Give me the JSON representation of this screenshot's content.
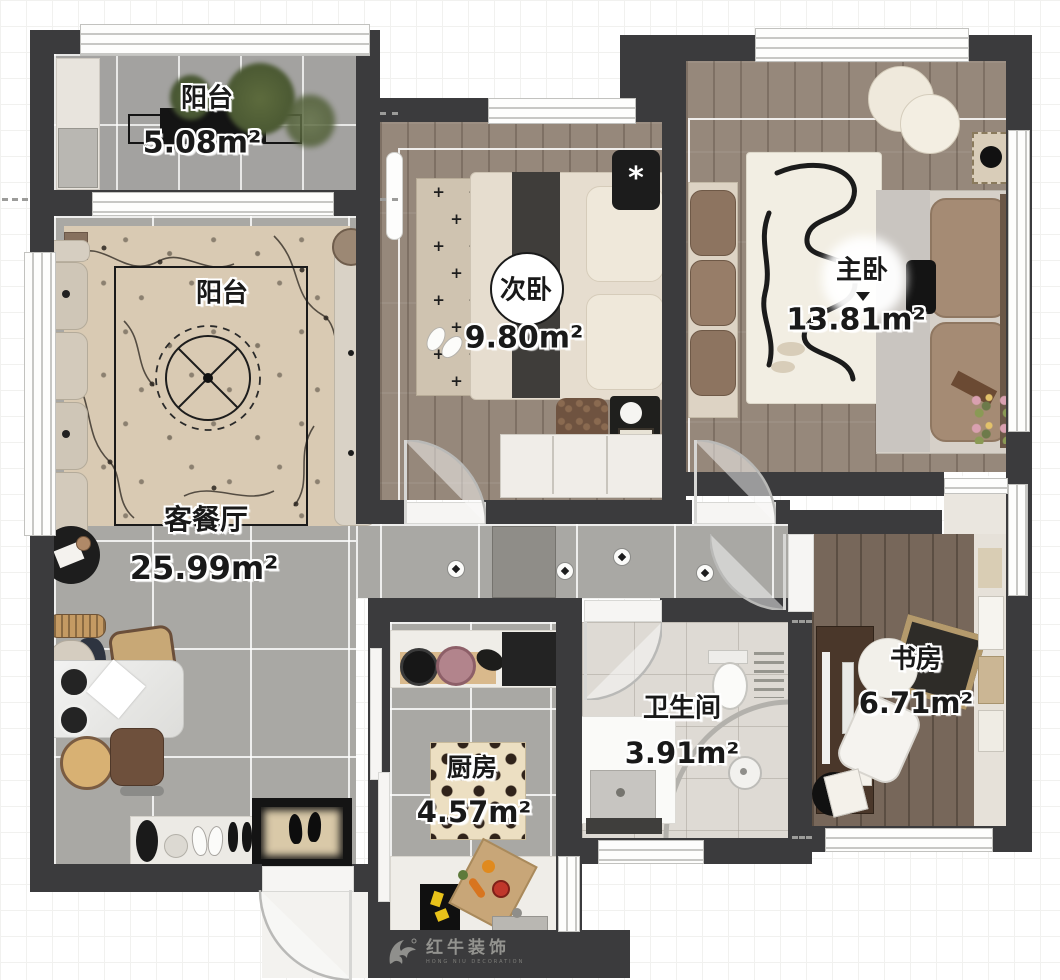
{
  "rooms": [
    {
      "id": "balcony-top",
      "name": "阳台",
      "area": "5.08m²"
    },
    {
      "id": "balcony-living",
      "name": "阳台",
      "area": ""
    },
    {
      "id": "bedroom-second",
      "name": "次卧",
      "area": "9.80m²"
    },
    {
      "id": "bedroom-master",
      "name": "主卧",
      "area": "13.81m²"
    },
    {
      "id": "living-dining",
      "name": "客餐厅",
      "area": "25.99m²"
    },
    {
      "id": "bathroom",
      "name": "卫生间",
      "area": "3.91m²"
    },
    {
      "id": "kitchen",
      "name": "厨房",
      "area": "4.57m²"
    },
    {
      "id": "study",
      "name": "书房",
      "area": "6.71m²"
    }
  ],
  "watermark": {
    "brand": "红牛装饰",
    "sub": "HONG NIU DECORATION"
  },
  "decor": {
    "plus_rug": "+ + +\n + + +\n+ + +\n + + +\n+ + +\n + + +\n+ + +",
    "asterisk": "*"
  },
  "colors": {
    "wall": "#3b3b3d",
    "tile": "#a9a8a4",
    "wood_light": "#96887b",
    "wood_dark": "#77675a",
    "rug_beige": "#d9cab3",
    "accent_black": "#141414"
  }
}
